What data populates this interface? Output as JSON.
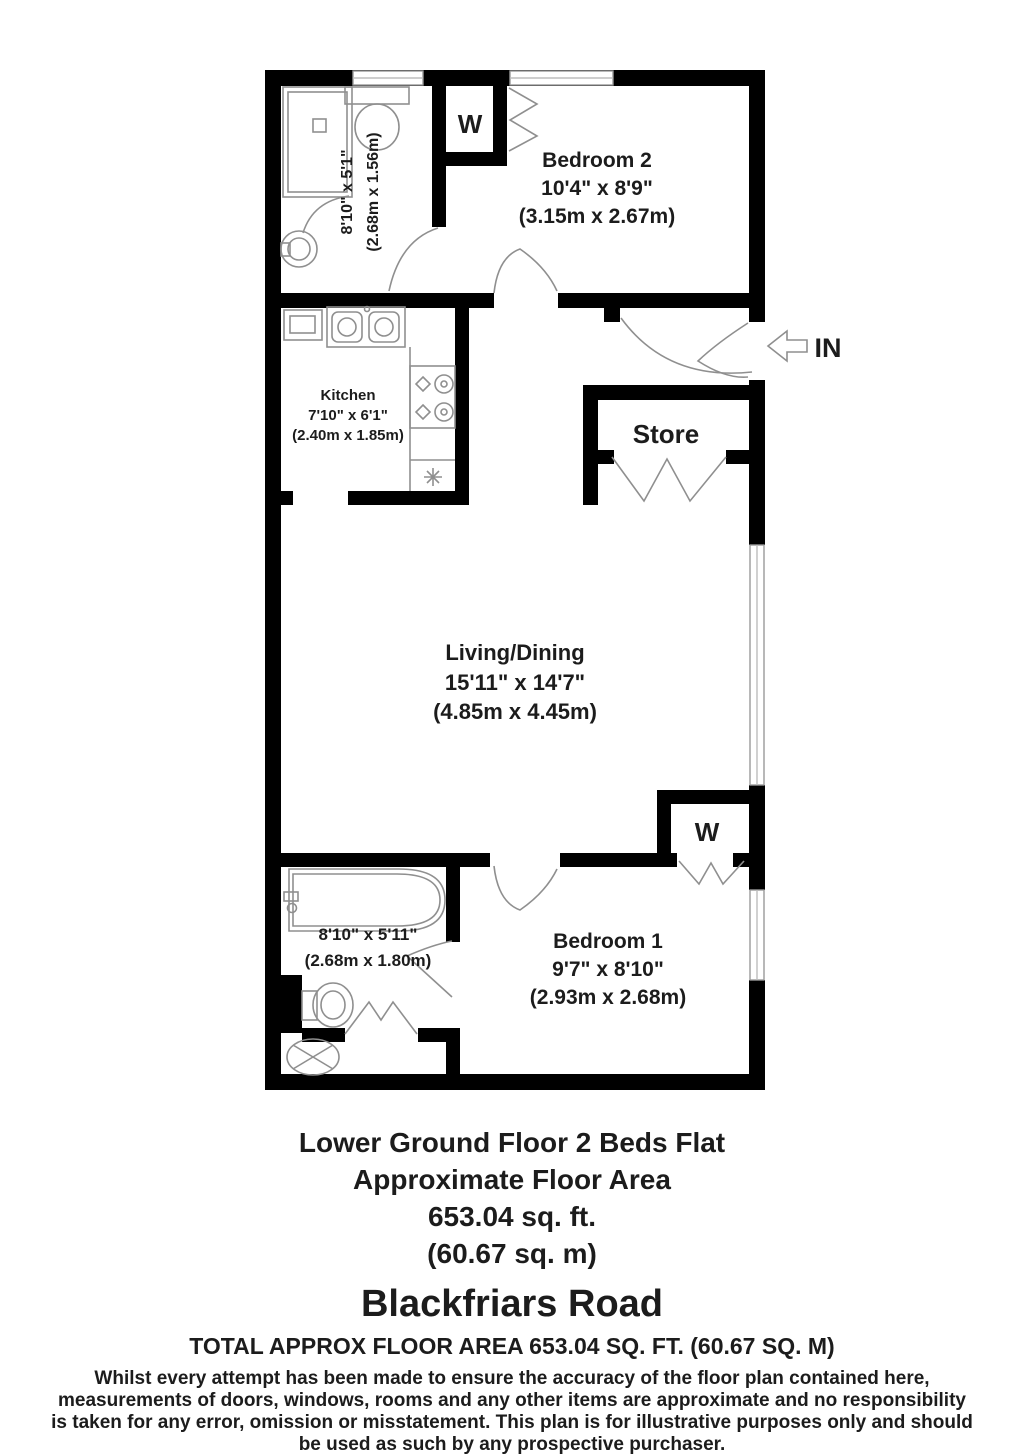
{
  "plan": {
    "wardrobe_label": "W",
    "entrance": {
      "label": "IN"
    },
    "store": {
      "name": "Store"
    },
    "bedroom2": {
      "name": "Bedroom 2",
      "imperial": "10'4\" x 8'9\"",
      "metric": "(3.15m x 2.67m)"
    },
    "bathroom_top": {
      "imperial": "8'10\" x 5'1\"",
      "metric": "(2.68m x 1.56m)"
    },
    "kitchen": {
      "name": "Kitchen",
      "imperial": "7'10\" x 6'1\"",
      "metric": "(2.40m x 1.85m)"
    },
    "living": {
      "name": "Living/Dining",
      "imperial": "15'11\" x 14'7\"",
      "metric": "(4.85m x 4.45m)"
    },
    "bedroom1": {
      "name": "Bedroom 1",
      "imperial": "9'7\" x 8'10\"",
      "metric": "(2.93m x 2.68m)"
    },
    "bathroom_bottom": {
      "imperial": "8'10\" x 5'11\"",
      "metric": "(2.68m x 1.80m)"
    }
  },
  "footer": {
    "summary_line1": "Lower Ground Floor 2 Beds Flat",
    "summary_line2": "Approximate Floor Area",
    "summary_line3": "653.04 sq. ft.",
    "summary_line4": "(60.67 sq. m)",
    "address": "Blackfriars Road",
    "total_area": "TOTAL APPROX FLOOR AREA 653.04 SQ. FT. (60.67 SQ. M)",
    "disclaimer": [
      "Whilst every attempt has been made to ensure the accuracy of the floor plan contained here,",
      "measurements of doors, windows, rooms and any other items are approximate and no responsibility",
      "is taken for any error, omission or misstatement. This plan is for illustrative purposes only and should",
      "be used as such by any prospective purchaser."
    ]
  },
  "colors": {
    "wall": "#000000",
    "fixture_line": "#8f8f8f",
    "text": "#1c1c1c",
    "background": "#ffffff"
  }
}
